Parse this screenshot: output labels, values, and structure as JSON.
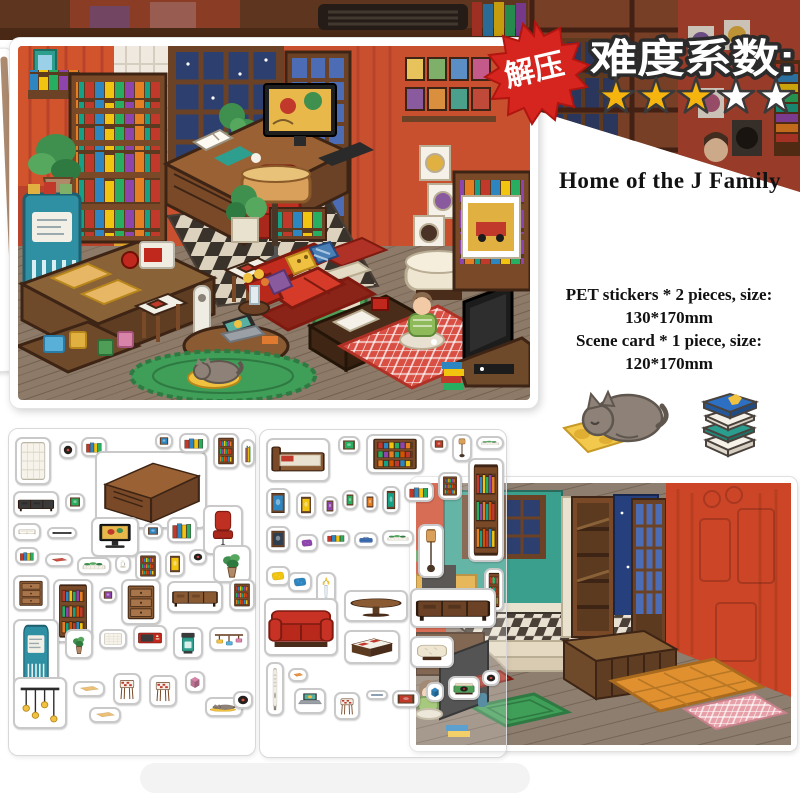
{
  "header": {
    "stress_badge": "解压",
    "difficulty_label": "难度系数:",
    "stars": {
      "filled": 3,
      "total": 5,
      "filled_color": "#f6b40e",
      "empty_color": "#ffffff",
      "outline_color": "#3a3a3a"
    },
    "badge_color": "#d6251f"
  },
  "product": {
    "title": "Home of the J Family",
    "specs": [
      "PET stickers * 2 pieces, size:",
      "130*170mm",
      "Scene card * 1 piece, size:",
      "120*170mm"
    ]
  },
  "sticker_sheets": {
    "left": {
      "stickers": [
        {
          "kind": "panel",
          "x": 6,
          "y": 8,
          "w": 36,
          "h": 48
        },
        {
          "kind": "record",
          "x": 50,
          "y": 12,
          "w": 18,
          "h": 18
        },
        {
          "kind": "books",
          "x": 72,
          "y": 8,
          "w": 26,
          "h": 20
        },
        {
          "kind": "desk",
          "x": 86,
          "y": 22,
          "w": 112,
          "h": 78
        },
        {
          "kind": "frame",
          "x": 146,
          "y": 4,
          "w": 18,
          "h": 16,
          "c": "#2e86c1"
        },
        {
          "kind": "books",
          "x": 170,
          "y": 4,
          "w": 30,
          "h": 20
        },
        {
          "kind": "shelf",
          "x": 204,
          "y": 4,
          "w": 26,
          "h": 36
        },
        {
          "kind": "books",
          "x": 232,
          "y": 10,
          "w": 14,
          "h": 28
        },
        {
          "kind": "tvconsole",
          "x": 4,
          "y": 62,
          "w": 46,
          "h": 26,
          "c": "#3a3a3a"
        },
        {
          "kind": "frame",
          "x": 56,
          "y": 64,
          "w": 20,
          "h": 18,
          "c": "#27ae60"
        },
        {
          "kind": "bookopen",
          "x": 4,
          "y": 94,
          "w": 28,
          "h": 18
        },
        {
          "kind": "tablet",
          "x": 38,
          "y": 98,
          "w": 30,
          "h": 12,
          "c": "#2f2f2f"
        },
        {
          "kind": "monitor",
          "x": 82,
          "y": 88,
          "w": 48,
          "h": 40
        },
        {
          "kind": "frame",
          "x": 134,
          "y": 94,
          "w": 20,
          "h": 16,
          "c": "#2e86c1"
        },
        {
          "kind": "books",
          "x": 158,
          "y": 88,
          "w": 30,
          "h": 26
        },
        {
          "kind": "chair",
          "x": 194,
          "y": 76,
          "w": 40,
          "h": 50
        },
        {
          "kind": "books",
          "x": 6,
          "y": 118,
          "w": 24,
          "h": 18
        },
        {
          "kind": "mat",
          "x": 36,
          "y": 124,
          "w": 28,
          "h": 14,
          "c": "#c0392b"
        },
        {
          "kind": "planter",
          "x": 68,
          "y": 128,
          "w": 34,
          "h": 18
        },
        {
          "kind": "coffee",
          "x": 106,
          "y": 126,
          "w": 16,
          "h": 18
        },
        {
          "kind": "shelf",
          "x": 126,
          "y": 122,
          "w": 26,
          "h": 30
        },
        {
          "kind": "frame",
          "x": 156,
          "y": 122,
          "w": 20,
          "h": 26,
          "c": "#f1c40f"
        },
        {
          "kind": "record",
          "x": 180,
          "y": 120,
          "w": 18,
          "h": 16
        },
        {
          "kind": "plant",
          "x": 204,
          "y": 116,
          "w": 38,
          "h": 38
        },
        {
          "kind": "drawers",
          "x": 4,
          "y": 146,
          "w": 36,
          "h": 36
        },
        {
          "kind": "shelf",
          "x": 44,
          "y": 150,
          "w": 40,
          "h": 64
        },
        {
          "kind": "frame",
          "x": 90,
          "y": 158,
          "w": 18,
          "h": 16,
          "c": "#8e44ad"
        },
        {
          "kind": "drawers",
          "x": 112,
          "y": 150,
          "w": 40,
          "h": 46
        },
        {
          "kind": "tvconsole",
          "x": 158,
          "y": 152,
          "w": 56,
          "h": 32,
          "c": "#8a5a33"
        },
        {
          "kind": "shelf",
          "x": 220,
          "y": 150,
          "w": 26,
          "h": 32
        },
        {
          "kind": "fridge",
          "x": 4,
          "y": 190,
          "w": 46,
          "h": 76
        },
        {
          "kind": "plant",
          "x": 56,
          "y": 200,
          "w": 28,
          "h": 30
        },
        {
          "kind": "panel",
          "x": 90,
          "y": 200,
          "w": 28,
          "h": 20
        },
        {
          "kind": "microwave",
          "x": 124,
          "y": 196,
          "w": 34,
          "h": 26
        },
        {
          "kind": "coffeemaker",
          "x": 164,
          "y": 198,
          "w": 30,
          "h": 32
        },
        {
          "kind": "rack",
          "x": 200,
          "y": 198,
          "w": 40,
          "h": 24
        },
        {
          "kind": "mobile",
          "x": 4,
          "y": 248,
          "w": 54,
          "h": 52
        },
        {
          "kind": "mat",
          "x": 64,
          "y": 252,
          "w": 32,
          "h": 16,
          "c": "#e8b765"
        },
        {
          "kind": "mat",
          "x": 80,
          "y": 278,
          "w": 32,
          "h": 16,
          "c": "#e8b765"
        },
        {
          "kind": "stool",
          "x": 104,
          "y": 244,
          "w": 28,
          "h": 32
        },
        {
          "kind": "stool",
          "x": 140,
          "y": 246,
          "w": 28,
          "h": 32
        },
        {
          "kind": "box",
          "x": 176,
          "y": 242,
          "w": 20,
          "h": 22,
          "c": "#d884a8"
        },
        {
          "kind": "cat",
          "x": 196,
          "y": 268,
          "w": 38,
          "h": 20
        },
        {
          "kind": "record",
          "x": 224,
          "y": 262,
          "w": 20,
          "h": 18
        }
      ]
    },
    "middle": {
      "stickers": [
        {
          "kind": "bed",
          "x": 6,
          "y": 8,
          "w": 64,
          "h": 44
        },
        {
          "kind": "frame",
          "x": 78,
          "y": 6,
          "w": 22,
          "h": 18,
          "c": "#27ae60"
        },
        {
          "kind": "shelf",
          "x": 106,
          "y": 4,
          "w": 58,
          "h": 40
        },
        {
          "kind": "frame",
          "x": 170,
          "y": 6,
          "w": 18,
          "h": 16,
          "c": "#c0392b"
        },
        {
          "kind": "lamp",
          "x": 192,
          "y": 4,
          "w": 20,
          "h": 28
        },
        {
          "kind": "planter",
          "x": 216,
          "y": 6,
          "w": 28,
          "h": 14
        },
        {
          "kind": "frame",
          "x": 6,
          "y": 58,
          "w": 24,
          "h": 30,
          "c": "#2e86c1"
        },
        {
          "kind": "frame",
          "x": 36,
          "y": 62,
          "w": 20,
          "h": 26,
          "c": "#f1c40f"
        },
        {
          "kind": "frame",
          "x": 62,
          "y": 66,
          "w": 16,
          "h": 20,
          "c": "#8e44ad"
        },
        {
          "kind": "frame",
          "x": 82,
          "y": 60,
          "w": 16,
          "h": 20,
          "c": "#27ae60"
        },
        {
          "kind": "frame",
          "x": 102,
          "y": 62,
          "w": 16,
          "h": 20,
          "c": "#e67e22"
        },
        {
          "kind": "frame",
          "x": 122,
          "y": 56,
          "w": 18,
          "h": 28,
          "c": "#16a085"
        },
        {
          "kind": "books",
          "x": 144,
          "y": 52,
          "w": 30,
          "h": 20
        },
        {
          "kind": "shelf",
          "x": 178,
          "y": 42,
          "w": 24,
          "h": 28
        },
        {
          "kind": "shelf",
          "x": 208,
          "y": 28,
          "w": 36,
          "h": 104
        },
        {
          "kind": "frame",
          "x": 6,
          "y": 96,
          "w": 24,
          "h": 26,
          "c": "#2c3e50"
        },
        {
          "kind": "pillow",
          "x": 36,
          "y": 104,
          "w": 22,
          "h": 18,
          "c": "#8e44ad"
        },
        {
          "kind": "books",
          "x": 62,
          "y": 100,
          "w": 28,
          "h": 16
        },
        {
          "kind": "suitcase",
          "x": 94,
          "y": 102,
          "w": 24,
          "h": 16
        },
        {
          "kind": "planter",
          "x": 122,
          "y": 100,
          "w": 32,
          "h": 16
        },
        {
          "kind": "lamp",
          "x": 158,
          "y": 94,
          "w": 26,
          "h": 54
        },
        {
          "kind": "shelf",
          "x": 224,
          "y": 138,
          "w": 20,
          "h": 44
        },
        {
          "kind": "pillow",
          "x": 6,
          "y": 136,
          "w": 24,
          "h": 20,
          "c": "#f1c40f"
        },
        {
          "kind": "pillow",
          "x": 28,
          "y": 142,
          "w": 24,
          "h": 20,
          "c": "#2e86c1"
        },
        {
          "kind": "vase",
          "x": 56,
          "y": 142,
          "w": 20,
          "h": 32
        },
        {
          "kind": "sofa",
          "x": 4,
          "y": 168,
          "w": 74,
          "h": 58
        },
        {
          "kind": "tableround",
          "x": 84,
          "y": 160,
          "w": 64,
          "h": 32
        },
        {
          "kind": "checkertable",
          "x": 84,
          "y": 200,
          "w": 56,
          "h": 34
        },
        {
          "kind": "tvconsole",
          "x": 150,
          "y": 158,
          "w": 86,
          "h": 40,
          "c": "#6b4226"
        },
        {
          "kind": "ottoman",
          "x": 150,
          "y": 206,
          "w": 44,
          "h": 32
        },
        {
          "kind": "tower",
          "x": 6,
          "y": 232,
          "w": 18,
          "h": 54
        },
        {
          "kind": "mat",
          "x": 28,
          "y": 238,
          "w": 20,
          "h": 14,
          "c": "#e67e22"
        },
        {
          "kind": "laptop",
          "x": 34,
          "y": 258,
          "w": 32,
          "h": 26
        },
        {
          "kind": "stool",
          "x": 74,
          "y": 262,
          "w": 26,
          "h": 28
        },
        {
          "kind": "tablet",
          "x": 106,
          "y": 260,
          "w": 22,
          "h": 10,
          "c": "#3a6fa8"
        },
        {
          "kind": "frame",
          "x": 132,
          "y": 260,
          "w": 28,
          "h": 18,
          "c": "#c0392b"
        },
        {
          "kind": "box",
          "x": 166,
          "y": 252,
          "w": 18,
          "h": 20,
          "c": "#2e86c1"
        },
        {
          "kind": "player",
          "x": 188,
          "y": 246,
          "w": 32,
          "h": 24
        },
        {
          "kind": "record",
          "x": 222,
          "y": 240,
          "w": 18,
          "h": 16
        }
      ]
    }
  }
}
